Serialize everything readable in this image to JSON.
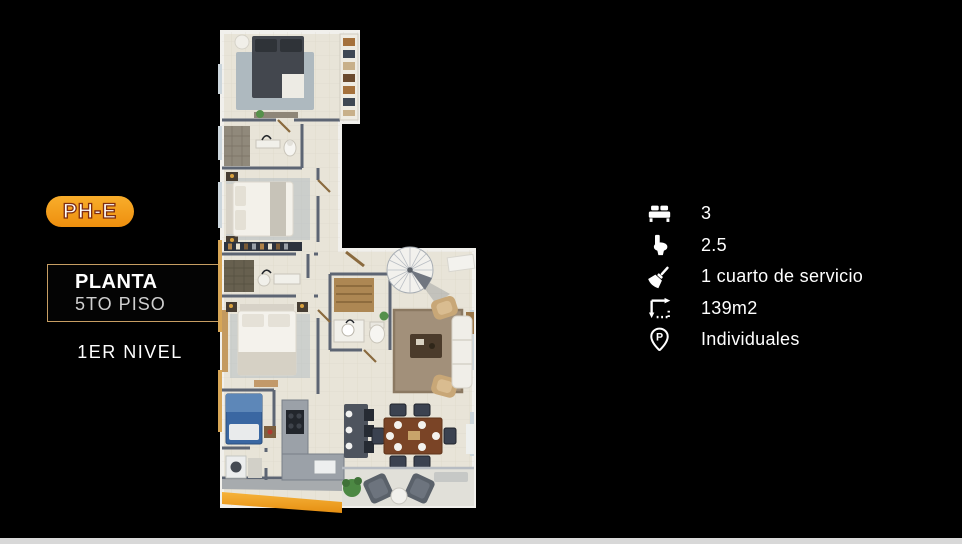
{
  "page": {
    "bg_color": "#000000",
    "footer_bar_color": "#d8d8d8"
  },
  "unit_badge": {
    "label": "PH-E",
    "bg_color": "#f29a17",
    "text_color": "#ffffff",
    "outline_color": "#7e2c10"
  },
  "plan_card": {
    "title": "PLANTA",
    "subtitle": "5TO PISO",
    "border_color": "#c79e63"
  },
  "level_label": "1ER NIVEL",
  "specs": [
    {
      "icon": "bed-icon",
      "label": "3"
    },
    {
      "icon": "toilet-icon",
      "label": "2.5"
    },
    {
      "icon": "broom-icon",
      "label": "1 cuarto de servicio"
    },
    {
      "icon": "area-icon",
      "label": "139m2"
    },
    {
      "icon": "parking-pin-icon",
      "label": "Individuales"
    }
  ],
  "icons": {
    "parking_letter": "P"
  }
}
